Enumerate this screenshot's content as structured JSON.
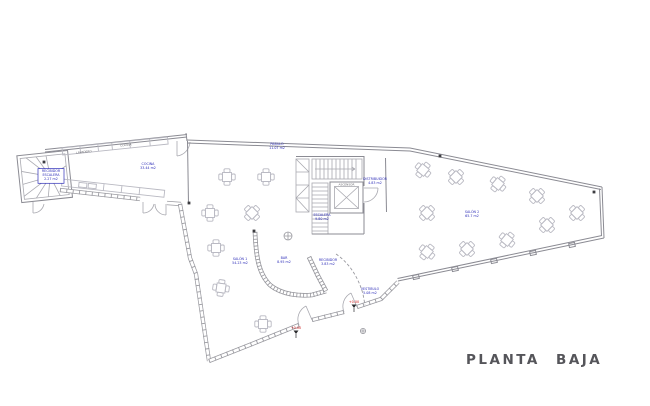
{
  "title": "PLANTA  BAJA",
  "colors": {
    "label_blue": "#2e2eb8",
    "level_red": "#cc1414",
    "wall_gray": "#8b8b93",
    "furniture_gray": "#b9b9c2",
    "title_gray": "#55555a",
    "background": "#ffffff"
  },
  "rooms": [
    {
      "name": "RECIBIDOR",
      "lines": [
        "RECIBIDOR",
        "ESCALERA",
        "2.27 m2"
      ],
      "x": 51,
      "y": 172,
      "boxed": true
    },
    {
      "name": "COCINA",
      "lines": [
        "COCINA",
        "33.44 m2"
      ],
      "x": 148,
      "y": 165,
      "boxed": false
    },
    {
      "name": "PASILLO",
      "lines": [
        "PASILLO",
        "11.07 m2"
      ],
      "x": 277,
      "y": 145,
      "boxed": false
    },
    {
      "name": "DISTRIBUIDOR",
      "lines": [
        "DISTRIBUIDOR",
        "4.83 m2"
      ],
      "x": 375,
      "y": 180,
      "boxed": false
    },
    {
      "name": "ESCALERA",
      "lines": [
        "ESCALERA",
        "9.80 m2"
      ],
      "x": 322,
      "y": 216,
      "boxed": false
    },
    {
      "name": "SALON 1",
      "lines": [
        "SALÓN 1",
        "54.23 m2"
      ],
      "x": 240,
      "y": 260,
      "boxed": false
    },
    {
      "name": "BAR",
      "lines": [
        "BAR",
        "8.95 m2"
      ],
      "x": 284,
      "y": 259,
      "boxed": false
    },
    {
      "name": "RECIBIDOR-2",
      "lines": [
        "RECIBIDOR",
        "3.83 m2"
      ],
      "x": 328,
      "y": 261,
      "boxed": false
    },
    {
      "name": "SALON 2",
      "lines": [
        "SALÓN 2",
        "65.7 m2"
      ],
      "x": 472,
      "y": 213,
      "boxed": false
    },
    {
      "name": "VESTIBULO",
      "lines": [
        "VESTIBULO",
        "5.08 m2"
      ],
      "x": 370,
      "y": 290,
      "boxed": false
    }
  ],
  "fixed_labels": [
    {
      "text": "LAVADERO",
      "x": 84,
      "y": 153,
      "angle": -6
    },
    {
      "text": "COCINA",
      "x": 126,
      "y": 146,
      "angle": -6
    },
    {
      "text": "ASCENSOR",
      "x": 346.5,
      "y": 185.3,
      "angle": 0
    }
  ],
  "level_marks": [
    {
      "text": "+0.00",
      "x": 296,
      "y": 329
    },
    {
      "text": "+0.00",
      "x": 354,
      "y": 303
    }
  ],
  "tables": [
    {
      "x": 227,
      "y": 177,
      "r": 0
    },
    {
      "x": 266,
      "y": 177,
      "r": 0
    },
    {
      "x": 210,
      "y": 213,
      "r": 0
    },
    {
      "x": 252,
      "y": 213,
      "r": 45
    },
    {
      "x": 216,
      "y": 248,
      "r": 0
    },
    {
      "x": 221,
      "y": 288,
      "r": 8
    },
    {
      "x": 263,
      "y": 324,
      "r": 0
    },
    {
      "x": 423,
      "y": 170,
      "r": 40
    },
    {
      "x": 456,
      "y": 177,
      "r": 45
    },
    {
      "x": 498,
      "y": 184,
      "r": 40
    },
    {
      "x": 537,
      "y": 196,
      "r": 45
    },
    {
      "x": 577,
      "y": 213,
      "r": 45
    },
    {
      "x": 427,
      "y": 213,
      "r": 45
    },
    {
      "x": 427,
      "y": 252,
      "r": 40
    },
    {
      "x": 467,
      "y": 249,
      "r": 45
    },
    {
      "x": 507,
      "y": 240,
      "r": 40
    },
    {
      "x": 547,
      "y": 225,
      "r": 45
    }
  ],
  "columns": [
    {
      "x": 440,
      "y": 156
    },
    {
      "x": 594,
      "y": 192
    },
    {
      "x": 254,
      "y": 231
    },
    {
      "x": 189,
      "y": 203
    },
    {
      "x": 44,
      "y": 162
    }
  ],
  "round_marks": [
    {
      "x": 288,
      "y": 236,
      "r": 4
    },
    {
      "x": 363,
      "y": 331,
      "r": 2.6
    }
  ]
}
